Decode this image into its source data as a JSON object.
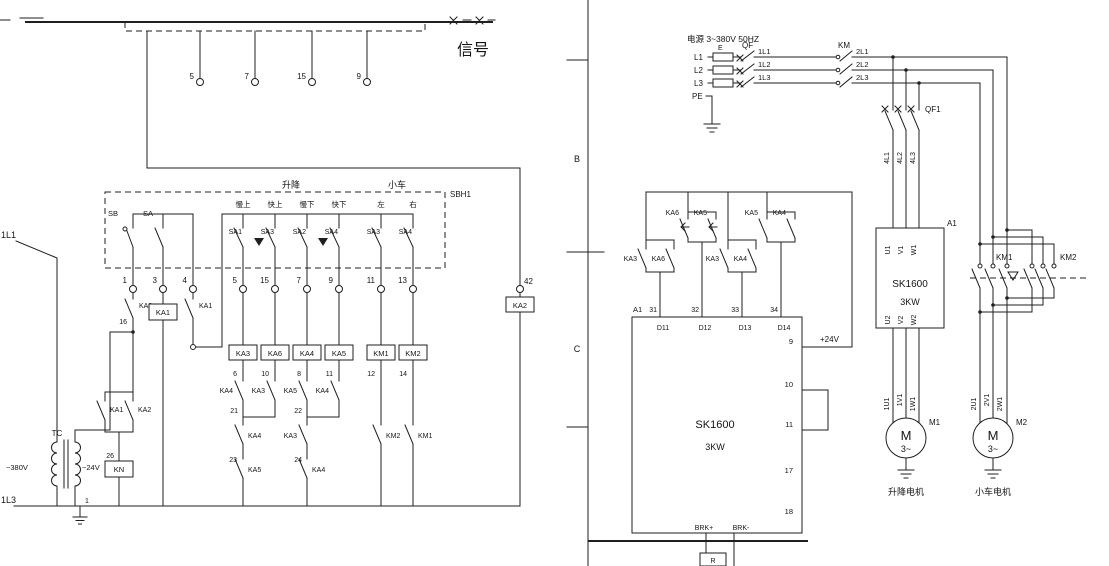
{
  "left": {
    "signal_label": "信号",
    "sbh1_label": "SBH1",
    "top_terminals": [
      "5",
      "7",
      "15",
      "9"
    ],
    "feeder_top": "1L1",
    "feeder_bottom": "1L3",
    "group_labels": [
      "升降",
      "小车"
    ],
    "column_labels": [
      "慢上",
      "快上",
      "慢下",
      "快下",
      "左",
      "右"
    ],
    "switch_names": [
      "SA1",
      "SA3",
      "SA2",
      "SA4",
      "SA3",
      "SA4"
    ],
    "sb_label": "SB",
    "sa_label": "SA",
    "panel_terminals": [
      "1",
      "3",
      "4"
    ],
    "switch_terminals": [
      "5",
      "15",
      "7",
      "9",
      "11",
      "13"
    ],
    "ka2_no_contact": "KA2",
    "wire_16": "16",
    "ka1_coil": "KA1",
    "ka1_no_contact": "KA1",
    "coil_names": [
      "KA3",
      "KA6",
      "KA4",
      "KA5",
      "KM1",
      "KM2"
    ],
    "coil_wire_numbers": [
      "6",
      "10",
      "8",
      "11",
      "12",
      "14"
    ],
    "interlock_col1": {
      "c1": "KA4",
      "n1": "21",
      "c2": "KA4",
      "n2": "23",
      "c3": "KA5"
    },
    "interlock_col2": {
      "c1": "KA3"
    },
    "interlock_col3": {
      "c1": "KA5",
      "n1": "22",
      "c2": "KA3",
      "n2": "24",
      "c3": "KA4"
    },
    "interlock_col4": {
      "c1": "KA4"
    },
    "km1_interlock": "KM2",
    "km2_interlock": "KM1",
    "tc_label": "TC",
    "primary_voltage": "~380V",
    "secondary_voltage": "~24V",
    "seal_ka1": "KA1",
    "seal_ka2": "KA2",
    "wire_26": "26",
    "kn_coil": "KN",
    "wire_1": "1",
    "terminal_42": "42",
    "ka2_coil": "KA2"
  },
  "right": {
    "supply_title": "电源 3~380V 50HZ",
    "phase_labels": [
      "L1",
      "L2",
      "L3",
      "PE"
    ],
    "terminal_e": "E",
    "qf_label": "QF",
    "wires_1": [
      "1L1",
      "1L2",
      "1L3"
    ],
    "km_label": "KM",
    "wires_2": [
      "2L1",
      "2L2",
      "2L3"
    ],
    "qf1_label": "QF1",
    "wires_4": [
      "4L1",
      "4L2",
      "4L3"
    ],
    "inverter": {
      "designator": "A1",
      "in_terminals": [
        "U1",
        "V1",
        "W1"
      ],
      "model": "SK1600",
      "power": "3KW",
      "out_terminals": [
        "U2",
        "V2",
        "W2"
      ]
    },
    "motor1": {
      "wires": [
        "1U1",
        "1V1",
        "1W1"
      ],
      "m": "M",
      "phase": "3~",
      "designator": "M1",
      "caption": "升降电机"
    },
    "motor2": {
      "wires": [
        "2U1",
        "2V1",
        "2W1"
      ],
      "m": "M",
      "phase": "3~",
      "designator": "M2",
      "caption": "小车电机"
    },
    "km1_label": "KM1",
    "km2_label": "KM2",
    "zone_b": "B",
    "zone_c": "C",
    "controller": {
      "designator": "A1",
      "wire_numbers": [
        "31",
        "32",
        "33",
        "34"
      ],
      "inputs": [
        "D11",
        "D12",
        "D13",
        "D14"
      ],
      "pair1": [
        "KA3",
        "KA6"
      ],
      "pair2": [
        "KA6",
        "KA5"
      ],
      "pair3": [
        "KA3",
        "KA4"
      ],
      "pair4": [
        "KA5",
        "KA4"
      ],
      "model": "SK1600",
      "power": "3KW",
      "terminals": [
        "9",
        "10",
        "11",
        "17",
        "18"
      ],
      "v24": "+24V",
      "brk_plus": "BRK+",
      "brk_minus": "BRK-",
      "resistor": "R"
    }
  }
}
